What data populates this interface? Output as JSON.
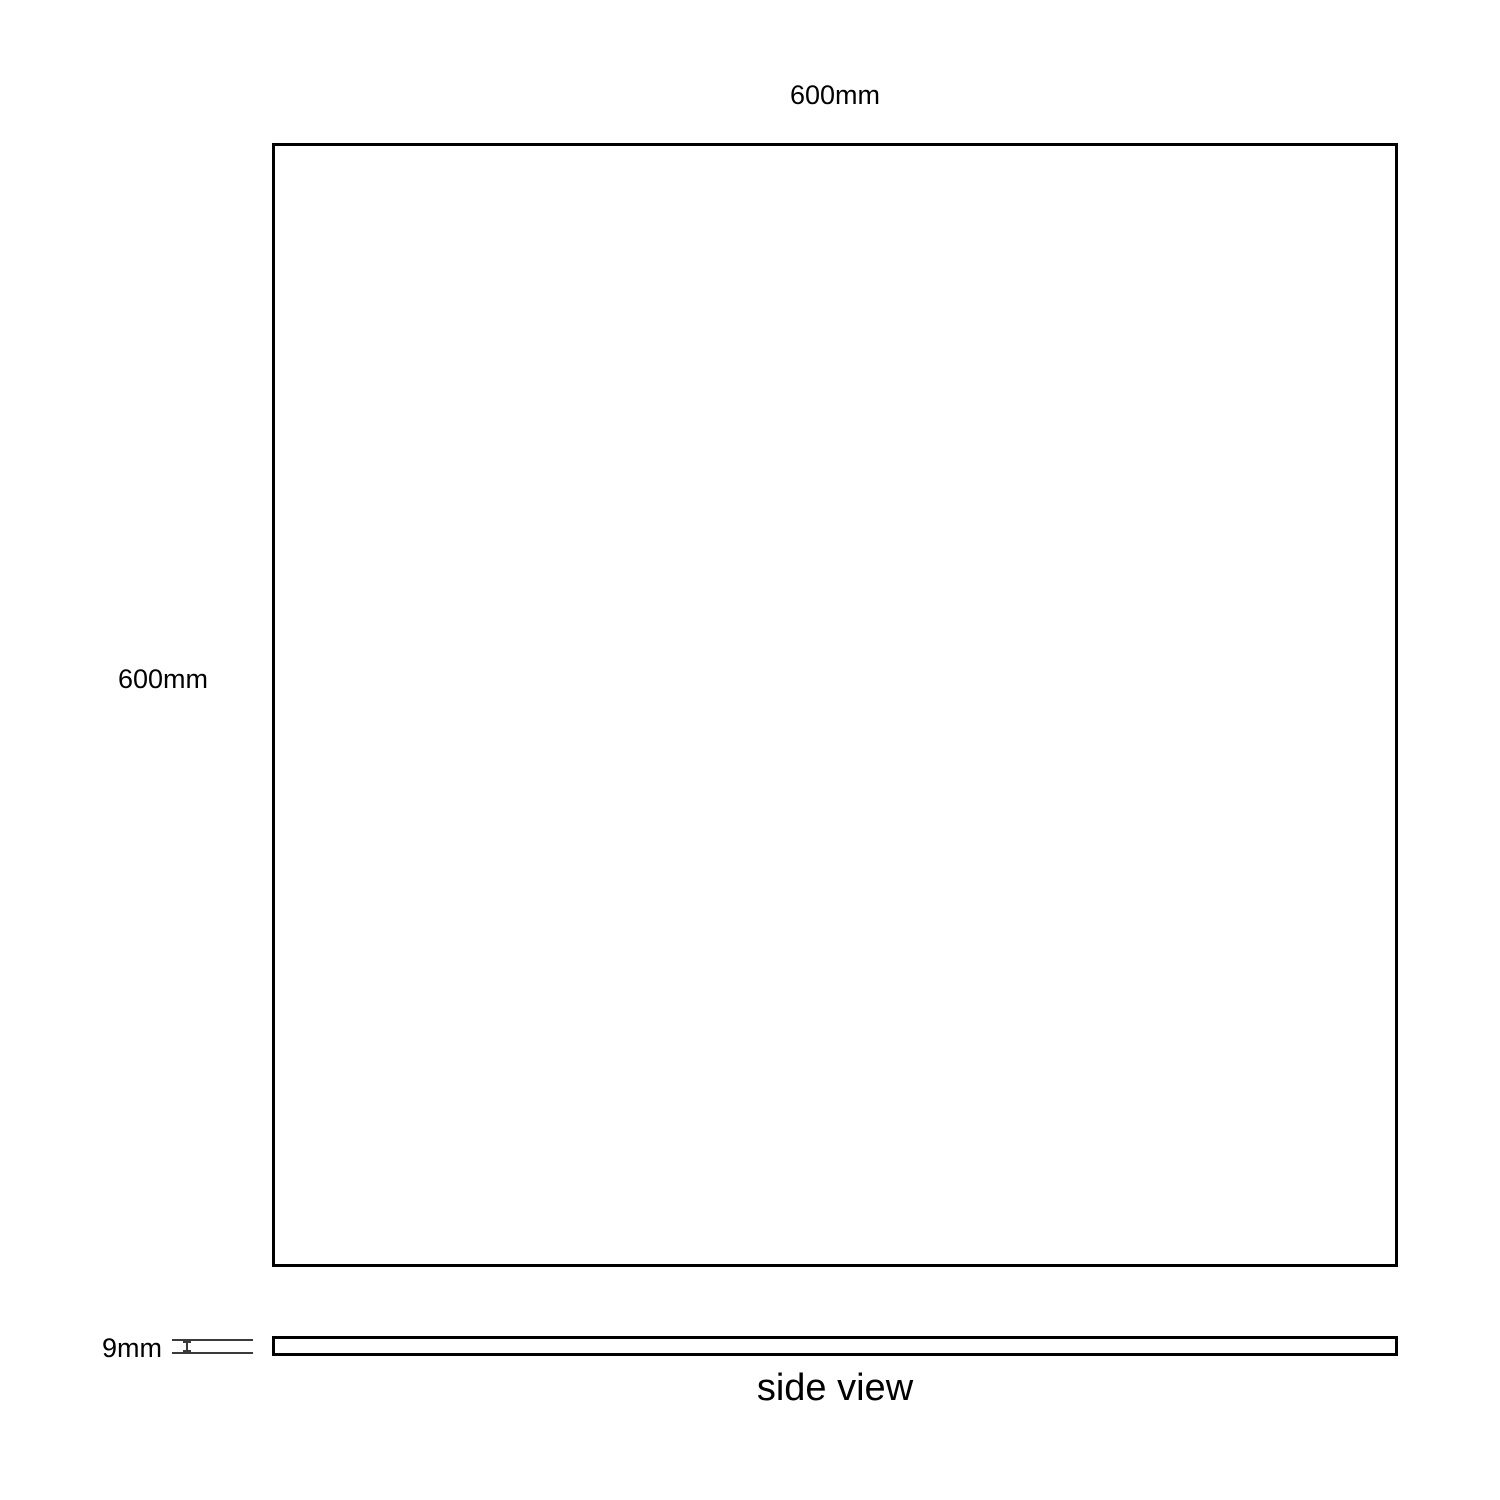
{
  "front_view": {
    "width_label": "600mm",
    "height_label": "600mm"
  },
  "side_view": {
    "thickness_label": "9mm",
    "caption": "side view"
  },
  "colors": {
    "panel_border": "#000000",
    "dimension_marker": "#3a3a3a",
    "background": "#ffffff"
  }
}
